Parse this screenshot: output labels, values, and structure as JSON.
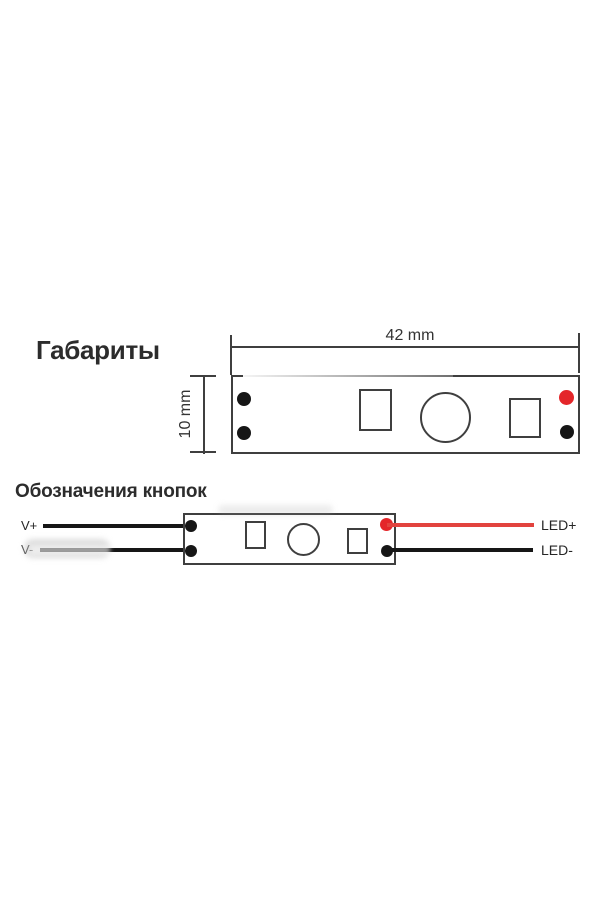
{
  "colors": {
    "line": "#3f3f3f",
    "ink": "#161616",
    "red": "#e4262a",
    "red_wire": "#e2433e",
    "heading": "#2c2c2c",
    "label": "#262626",
    "dim_text": "#333333"
  },
  "dimensions_section": {
    "title": "Габариты",
    "width_label": "42 mm",
    "height_label": "10 mm",
    "board": {
      "pads_left": [
        "black",
        "black"
      ],
      "pads_right": [
        "red",
        "black"
      ],
      "components": [
        "button-square",
        "touch-sensor-circle",
        "button-square"
      ]
    }
  },
  "wiring_section": {
    "title": "Обозначения кнопок",
    "input_wires": [
      {
        "label": "V+",
        "color": "black"
      },
      {
        "label": "V-",
        "color": "black"
      }
    ],
    "output_wires": [
      {
        "label": "LED+",
        "color": "red"
      },
      {
        "label": "LED-",
        "color": "black"
      }
    ]
  }
}
